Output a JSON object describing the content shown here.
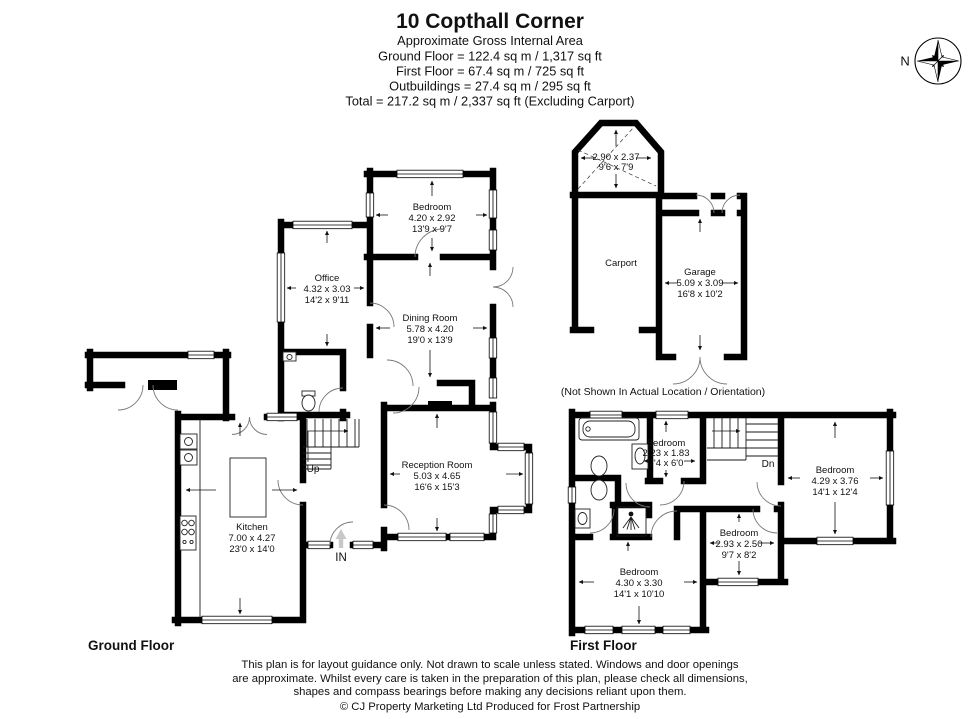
{
  "header": {
    "title": "10 Copthall Corner",
    "subtitle": "Approximate Gross Internal Area",
    "area_lines": [
      "Ground Floor = 122.4 sq m / 1,317 sq ft",
      "First Floor = 67.4 sq m / 725 sq ft",
      "Outbuildings = 27.4 sq m / 295 sq ft",
      "Total = 217.2 sq m / 2,337 sq ft (Excluding Carport)"
    ]
  },
  "compass": {
    "north": "N"
  },
  "ground_floor": {
    "label": "Ground Floor",
    "stairs_label": "Up",
    "entrance_label": "IN",
    "rooms": {
      "bedroom": {
        "name": "Bedroom",
        "metric": "4.20 x 2.92",
        "imperial": "13'9 x 9'7"
      },
      "office": {
        "name": "Office",
        "metric": "4.32 x 3.03",
        "imperial": "14'2 x 9'11"
      },
      "dining": {
        "name": "Dining Room",
        "metric": "5.78 x 4.20",
        "imperial": "19'0 x 13'9"
      },
      "reception": {
        "name": "Reception Room",
        "metric": "5.03 x 4.65",
        "imperial": "16'6 x 15'3"
      },
      "kitchen": {
        "name": "Kitchen",
        "metric": "7.00 x 4.27",
        "imperial": "23'0 x 14'0"
      }
    }
  },
  "first_floor": {
    "label": "First Floor",
    "stairs_label": "Dn",
    "rooms": {
      "bedroom_small": {
        "name": "Bedroom",
        "metric": "2.23 x 1.83",
        "imperial": "7'4 x 6'0"
      },
      "bedroom_right": {
        "name": "Bedroom",
        "metric": "4.29 x 3.76",
        "imperial": "14'1 x 12'4"
      },
      "bedroom_mid": {
        "name": "Bedroom",
        "metric": "2.93 x 2.50",
        "imperial": "9'7 x 8'2"
      },
      "bedroom_large": {
        "name": "Bedroom",
        "metric": "4.30 x 3.30",
        "imperial": "14'1 x 10'10"
      }
    }
  },
  "outbuildings": {
    "shed": {
      "metric": "2.90 x 2.37",
      "imperial": "9'6 x 7'9"
    },
    "carport": {
      "name": "Carport"
    },
    "garage": {
      "name": "Garage",
      "metric": "5.09 x 3.09",
      "imperial": "16'8 x 10'2"
    },
    "note": "(Not Shown In Actual Location / Orientation)"
  },
  "footer": {
    "disclaimer": [
      "This plan is for layout guidance only. Not drawn to scale unless stated. Windows and door openings",
      "are approximate. Whilst every care is taken in the preparation of this plan, please check all dimensions,",
      "shapes and compass bearings before making any decisions reliant upon them."
    ],
    "copyright": "© CJ Property Marketing Ltd Produced for Frost Partnership"
  }
}
